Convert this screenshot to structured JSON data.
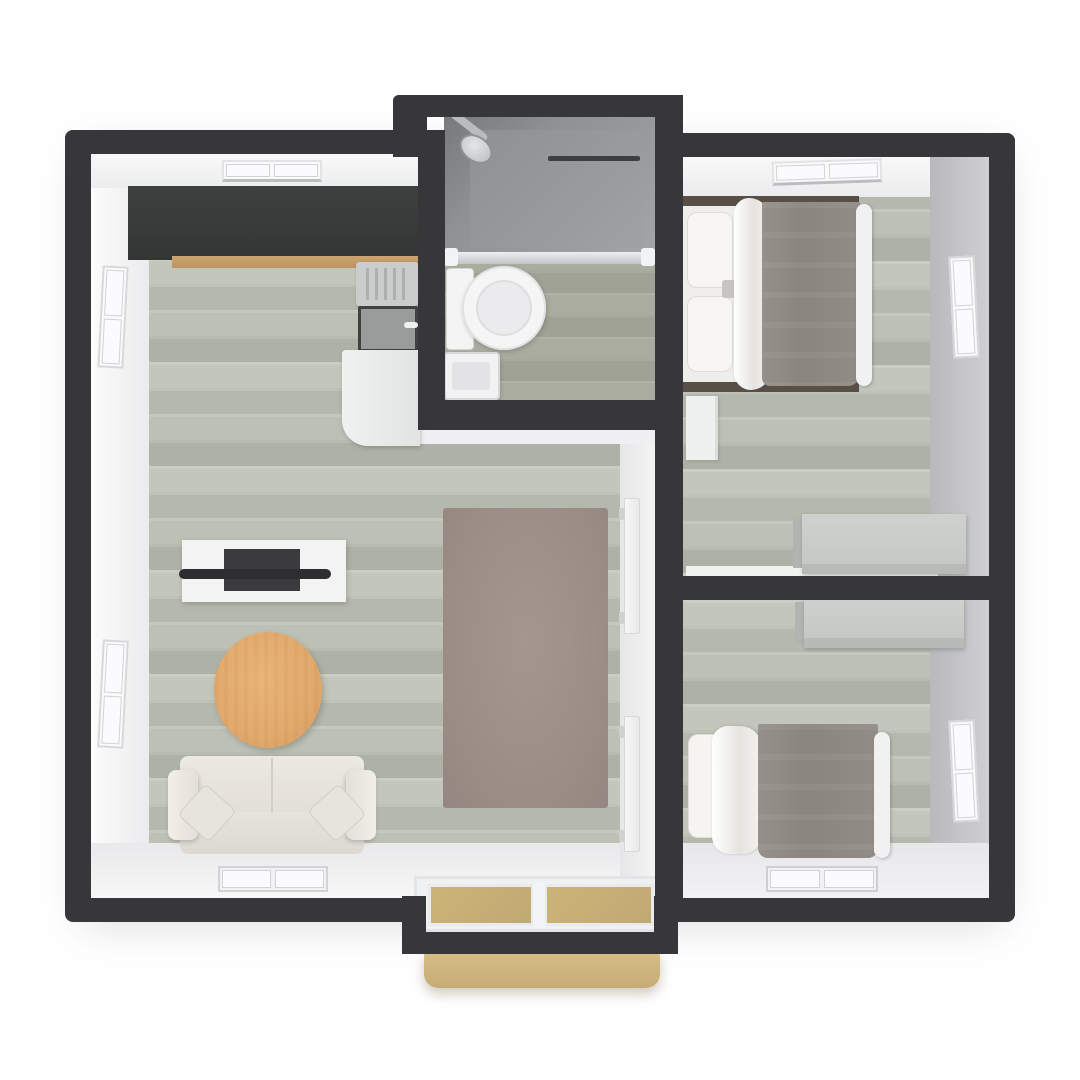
{
  "scene": {
    "title": "3D rendered floor plan, top-down view",
    "style": "isometric-top-down architectural render",
    "background": "#ffffff"
  },
  "palette": {
    "wall_dark": "#37373a",
    "wall_face_white": "#f2f2f4",
    "wall_face_gray": "#c7c7c9",
    "floor_wood_sage": "#bcc0b4",
    "floor_bath": "#a5a89a",
    "kitchen_counter_dark": "#3a3c3b",
    "kitchen_wood_strip": "#c79e67",
    "rug_taupe": "#9c8f88",
    "coffee_table_wood": "#e2a96c",
    "sofa_cream": "#e8e5dc",
    "bed_blanket_gray": "#8d8881",
    "linen_white": "#f4f3f0",
    "desk_gray": "#c9cbc8",
    "entry_glass_tan": "#c3ad7b",
    "entry_step_tan": "#cfb57e",
    "shower_gray": "#8f9194"
  },
  "rooms": {
    "living": {
      "label": "Open living room and kitchen",
      "features": [
        "wood plank floor",
        "two windows on left wall",
        "window on top wall",
        "window on bottom wall"
      ]
    },
    "bathroom": {
      "label": "Bathroom with shower, toilet and sink",
      "features": [
        "walk-in shower with glass partition",
        "shower head",
        "towel bar",
        "toilet",
        "small sink",
        "two top-wall window tabs"
      ]
    },
    "bedroom1": {
      "label": "Bedroom 1 (top right)",
      "features": [
        "double bed with gray blanket and pillows",
        "nightstand",
        "desk against divider wall",
        "top window",
        "right window"
      ]
    },
    "bedroom2": {
      "label": "Bedroom 2 (bottom right)",
      "features": [
        "double bed with gray blanket and pillow",
        "desk against divider wall",
        "bottom-wall window",
        "right window"
      ]
    },
    "entry": {
      "label": "Entry with sliding glass door and step",
      "features": [
        "two tan glass panels",
        "exterior step mat"
      ]
    }
  },
  "furniture": {
    "kitchen_counter": "dark kitchen counter run",
    "kitchen_unit": "stove grill, sink with faucet, white counter",
    "tv_stand": "white media stand with flat TV",
    "coffee_table": "round wooden coffee table",
    "sofa": "cream two-seat sofa with two throw pillows",
    "rug": "taupe area rug",
    "beds": "two double beds with gray blankets",
    "desks": "two gray desks",
    "nightstand": "white nightstand"
  }
}
